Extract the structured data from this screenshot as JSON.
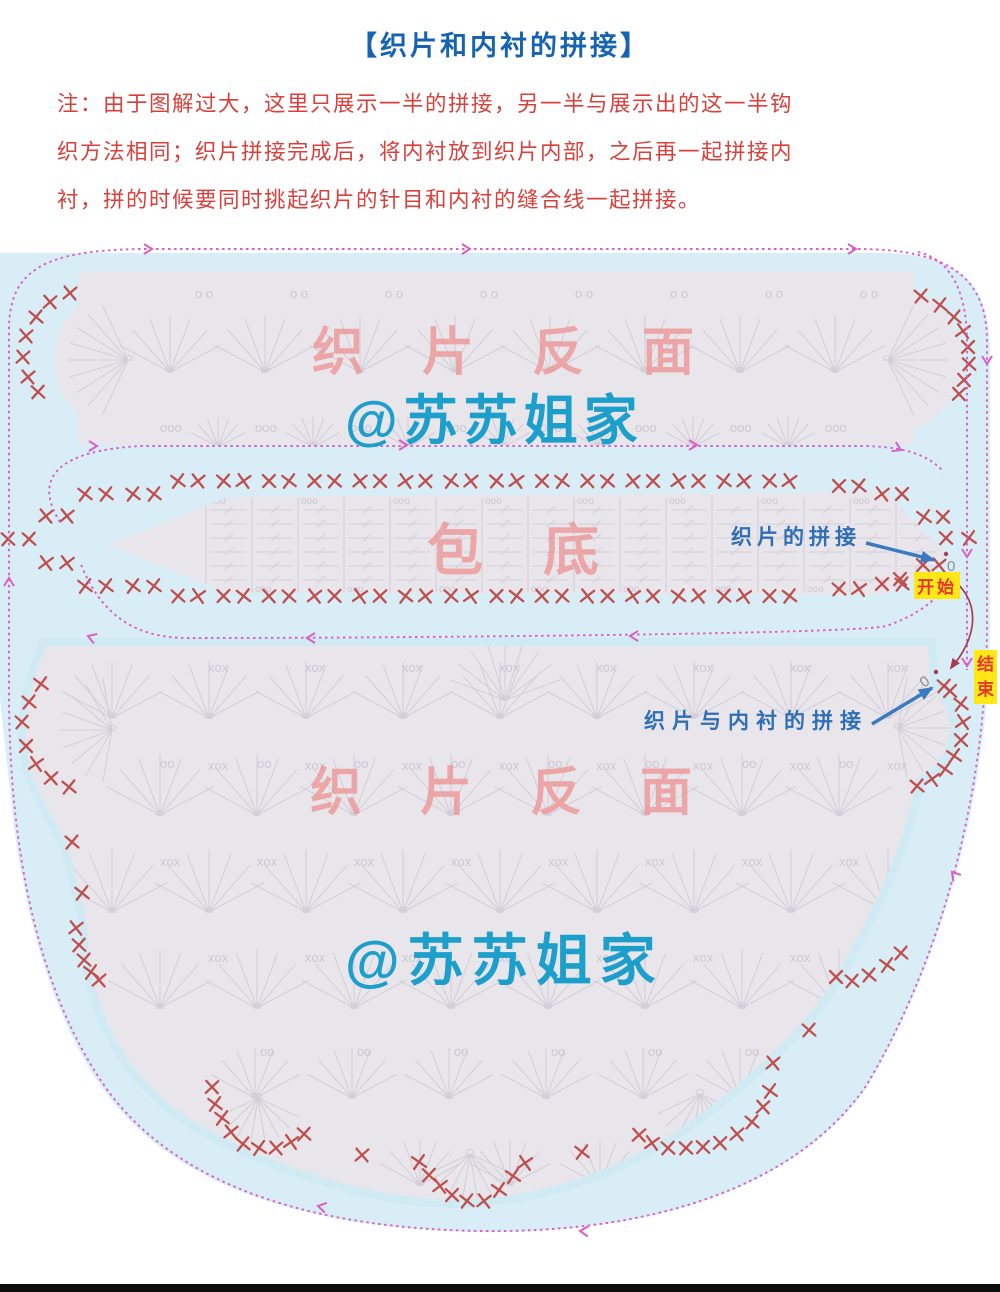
{
  "page": {
    "title": "【织片和内衬的拼接】",
    "note_lines": [
      "注：由于图解过大，这里只展示一半的拼接，另一半与展示出的这一半钩",
      "织方法相同；织片拼接完成后，将内衬放到织片内部，之后再一起拼接内",
      "衬，拼的时候要同时挑起织片的针目和内衬的缝合线一起拼接。"
    ]
  },
  "watermarks": {
    "top_piece_back": "织片反面",
    "top_handle": "@苏苏姐家",
    "middle_bottom": "包底",
    "bottom_piece_back": "织片反面",
    "bottom_handle": "@苏苏姐家"
  },
  "annotations": {
    "join_pieces": "织片的拼接",
    "join_lining": "织片与内衬的拼接",
    "start": "开始",
    "end": "结束",
    "zero": "0"
  },
  "colors": {
    "title_blue": "#1763b2",
    "note_red": "#d8403c",
    "field_blue": "#d9edf6",
    "halo_blue": "#cfeaf2",
    "piece_gray": "#e9e6eb",
    "symbol_gray": "#d3ced9",
    "symbol_text": "#ccc7d4",
    "x_mark_red": "#bf4f4e",
    "dash_pink": "#d95fc4",
    "curve_dark_red": "#a93b52",
    "label_blue": "#2f6fb5",
    "arrow_blue": "#3a7bbf",
    "badge_yellow": "#ffe816",
    "badge_red": "#e43535",
    "marker_gray": "#8f8f8f",
    "bottom_bar": "#0c0c0c"
  },
  "diagram": {
    "shapes": {
      "blue_field": "M0,253 L882,253 C968,253 990,292 990,352 L990,622 C990,795 941,963 867,1087 C793,1193 642,1234 481,1232 C328,1230 179,1195 103,1089 C50,1015 20,900 10,790 L0,700 Z",
      "top_band": {
        "rect": [
          78,
          271,
          836,
          174
        ],
        "bulges": [
          [
            128,
            360,
            74
          ],
          [
            888,
            360,
            74
          ]
        ]
      },
      "mid_strip": "M108,545 L228,497 L886,492 L948,556 L886,594 L228,593 Z",
      "bottom_dome": "M46,646 C28,688 18,736 34,780 C52,822 68,836 72,862 C80,896 88,914 88,948 C90,984 104,1020 124,1054 C148,1090 184,1120 224,1138 C298,1174 380,1200 462,1200 C560,1196 640,1160 706,1110 C760,1068 800,1030 830,986 C868,922 898,860 912,800 C926,754 932,704 928,646 Z",
      "bottom_bulges": [
        [
          112,
          730,
          56
        ],
        [
          898,
          728,
          52
        ]
      ]
    },
    "dashes": [
      {
        "p": "M138,249 L858,249 C955,249 987,282 987,342 L987,622 C987,795 940,962 866,1086 C792,1192 642,1233 482,1231 C330,1229 182,1194 106,1088 C36,988 9,845 9,692 L9,330 C9,270 44,251 138,249 Z"
      },
      {
        "p": "M918,252 C953,260 967,296 967,342 L967,670"
      },
      {
        "p": "M60,522 C32,478 58,450 142,446 L858,446 C906,446 928,455 944,472"
      },
      {
        "p": "M952,578 C938,600 916,616 886,626 C858,634 400,638 188,638 C122,638 96,602 80,562"
      },
      {
        "p": "M944,574 C986,598 976,640 951,668",
        "solid": true,
        "red": true
      }
    ],
    "pink_arrows": [
      [
        152,
        249,
        0
      ],
      [
        470,
        249,
        0
      ],
      [
        856,
        249,
        0
      ],
      [
        987,
        364,
        90
      ],
      [
        580,
        1231,
        183
      ],
      [
        318,
        1206,
        192
      ],
      [
        9,
        578,
        270
      ],
      [
        952,
        872,
        230
      ],
      [
        967,
        557,
        90
      ],
      [
        967,
        666,
        90
      ],
      [
        97,
        446,
        0
      ],
      [
        407,
        445,
        0
      ],
      [
        697,
        445,
        0
      ],
      [
        901,
        450,
        25
      ],
      [
        630,
        636,
        180
      ],
      [
        307,
        638,
        180
      ],
      [
        88,
        636,
        200
      ]
    ],
    "blue_arrows": [
      [
        866,
        543,
        934,
        560
      ],
      [
        872,
        724,
        932,
        688
      ]
    ],
    "red_arrow_head": [
      951,
      668,
      125
    ],
    "x_pair_rows": [
      {
        "y": 481,
        "x0": 178,
        "step": 45.5,
        "n": 14,
        "gap": 20
      },
      {
        "y": 596,
        "x0": 178,
        "step": 45.5,
        "n": 14,
        "gap": 20
      }
    ],
    "x_marks": [
      [
        70,
        293
      ],
      [
        50,
        302
      ],
      [
        36,
        317
      ],
      [
        26,
        336
      ],
      [
        23,
        357
      ],
      [
        28,
        377
      ],
      [
        38,
        392
      ],
      [
        921,
        296
      ],
      [
        940,
        305
      ],
      [
        954,
        317
      ],
      [
        963,
        331
      ],
      [
        968,
        347
      ],
      [
        969,
        364
      ],
      [
        964,
        380
      ],
      [
        959,
        394
      ],
      [
        85,
        494
      ],
      [
        106,
        494
      ],
      [
        133,
        494
      ],
      [
        154,
        494
      ],
      [
        46,
        516
      ],
      [
        67,
        516
      ],
      [
        8,
        539
      ],
      [
        29,
        539
      ],
      [
        46,
        563
      ],
      [
        67,
        563
      ],
      [
        85,
        586
      ],
      [
        106,
        586
      ],
      [
        133,
        586
      ],
      [
        154,
        586
      ],
      [
        839,
        486
      ],
      [
        859,
        486
      ],
      [
        882,
        494
      ],
      [
        902,
        494
      ],
      [
        924,
        517
      ],
      [
        943,
        517
      ],
      [
        923,
        565
      ],
      [
        939,
        565
      ],
      [
        946,
        538
      ],
      [
        969,
        538
      ],
      [
        900,
        579
      ],
      [
        839,
        589
      ],
      [
        859,
        589
      ],
      [
        882,
        584
      ],
      [
        902,
        584
      ],
      [
        41,
        684
      ],
      [
        29,
        702
      ],
      [
        22,
        722
      ],
      [
        26,
        746
      ],
      [
        36,
        764
      ],
      [
        51,
        778
      ],
      [
        69,
        787
      ],
      [
        72,
        842
      ],
      [
        82,
        893
      ],
      [
        76,
        928
      ],
      [
        79,
        945
      ],
      [
        84,
        960
      ],
      [
        91,
        972
      ],
      [
        99,
        980
      ],
      [
        212,
        1087
      ],
      [
        215,
        1104
      ],
      [
        222,
        1118
      ],
      [
        231,
        1132
      ],
      [
        243,
        1144
      ],
      [
        259,
        1148
      ],
      [
        276,
        1148
      ],
      [
        291,
        1142
      ],
      [
        304,
        1134
      ],
      [
        362,
        1155
      ],
      [
        419,
        1162
      ],
      [
        429,
        1175
      ],
      [
        440,
        1186
      ],
      [
        452,
        1195
      ],
      [
        467,
        1201
      ],
      [
        484,
        1201
      ],
      [
        499,
        1190
      ],
      [
        513,
        1176
      ],
      [
        525,
        1163
      ],
      [
        582,
        1152
      ],
      [
        639,
        1135
      ],
      [
        652,
        1143
      ],
      [
        668,
        1148
      ],
      [
        686,
        1148
      ],
      [
        703,
        1147
      ],
      [
        720,
        1143
      ],
      [
        737,
        1134
      ],
      [
        752,
        1122
      ],
      [
        763,
        1107
      ],
      [
        770,
        1091
      ],
      [
        773,
        1063
      ],
      [
        809,
        1030
      ],
      [
        836,
        977
      ],
      [
        852,
        981
      ],
      [
        869,
        975
      ],
      [
        887,
        965
      ],
      [
        901,
        953
      ],
      [
        917,
        786
      ],
      [
        932,
        779
      ],
      [
        945,
        769
      ],
      [
        954,
        756
      ],
      [
        961,
        740
      ],
      [
        963,
        722
      ],
      [
        961,
        704
      ],
      [
        950,
        691
      ],
      [
        944,
        686
      ]
    ],
    "fan_rows": [
      {
        "piece": "top",
        "y": 372,
        "x0": 170,
        "step": 95,
        "n": 8,
        "r": 56
      },
      {
        "piece": "top",
        "y": 447,
        "x0": 218,
        "step": 95,
        "n": 7,
        "r": 30
      },
      {
        "piece": "bottom",
        "y": 718,
        "x0": 112,
        "step": 97,
        "n": 9,
        "r": 56
      },
      {
        "piece": "bottom",
        "y": 815,
        "x0": 160,
        "step": 97,
        "n": 8,
        "r": 60
      },
      {
        "piece": "bottom",
        "y": 912,
        "x0": 112,
        "step": 97,
        "n": 9,
        "r": 62
      },
      {
        "piece": "bottom",
        "y": 1008,
        "x0": 160,
        "step": 97,
        "n": 8,
        "r": 58
      },
      {
        "piece": "bottom",
        "y": 1098,
        "x0": 255,
        "step": 97,
        "n": 6,
        "r": 50
      },
      {
        "piece": "bottom",
        "y": 1185,
        "x0": 420,
        "step": 90,
        "n": 3,
        "r": 45
      }
    ],
    "fan_special": [
      {
        "piece": "top",
        "x": 128,
        "y": 360,
        "r": 60,
        "a0": 115,
        "a1": 245,
        "n": 9
      },
      {
        "piece": "top",
        "x": 888,
        "y": 360,
        "r": 60,
        "a0": -65,
        "a1": 65,
        "n": 9
      },
      {
        "piece": "bottom",
        "x": 112,
        "y": 730,
        "r": 52,
        "a0": 100,
        "a1": 260,
        "n": 9
      },
      {
        "piece": "bottom",
        "x": 898,
        "y": 728,
        "r": 50,
        "a0": -80,
        "a1": 80,
        "n": 9
      },
      {
        "piece": "bottom",
        "x": 505,
        "y": 700,
        "r": 58,
        "a0": -160,
        "a1": -20,
        "n": 9
      },
      {
        "piece": "bottom",
        "x": 258,
        "y": 1098,
        "r": 44,
        "a0": 25,
        "a1": 155,
        "n": 8
      },
      {
        "piece": "bottom",
        "x": 470,
        "y": 1154,
        "r": 44,
        "a0": 25,
        "a1": 155,
        "n": 8
      },
      {
        "piece": "bottom",
        "x": 700,
        "y": 1094,
        "r": 46,
        "a0": 25,
        "a1": 155,
        "n": 8
      }
    ],
    "symbol_texts": [
      {
        "piece": "top",
        "y": 298,
        "x0": 195,
        "step": 95,
        "n": 8,
        "t": "o o"
      },
      {
        "piece": "top",
        "y": 432,
        "x0": 160,
        "step": 95,
        "n": 8,
        "t": "ooo"
      },
      {
        "piece": "bottom",
        "y": 672,
        "x0": 208,
        "step": 97,
        "n": 8,
        "t": "xox"
      },
      {
        "piece": "bottom",
        "y": 768,
        "x0": 160,
        "step": 97,
        "n": 8,
        "t": "oo"
      },
      {
        "piece": "bottom",
        "y": 770,
        "x0": 208,
        "step": 97,
        "n": 8,
        "t": "xox"
      },
      {
        "piece": "bottom",
        "y": 866,
        "x0": 160,
        "step": 97,
        "n": 8,
        "t": "xox"
      },
      {
        "piece": "bottom",
        "y": 962,
        "x0": 208,
        "step": 97,
        "n": 8,
        "t": "xox"
      },
      {
        "piece": "bottom",
        "y": 1056,
        "x0": 260,
        "step": 97,
        "n": 6,
        "t": "oo"
      }
    ],
    "mid_grid": {
      "x0": 206,
      "step": 46,
      "n": 16,
      "top": 498,
      "bot": 592,
      "dash_rows": [
        510,
        524,
        538,
        552,
        566,
        580
      ],
      "oo": "ooo"
    },
    "markers": {
      "start_zero": {
        "x": 947,
        "y": 571
      },
      "start_dot": {
        "x": 946,
        "y": 554
      },
      "end_zero": {
        "x": 924,
        "y": 688
      },
      "end_dot": {
        "x": 936,
        "y": 672
      }
    }
  }
}
